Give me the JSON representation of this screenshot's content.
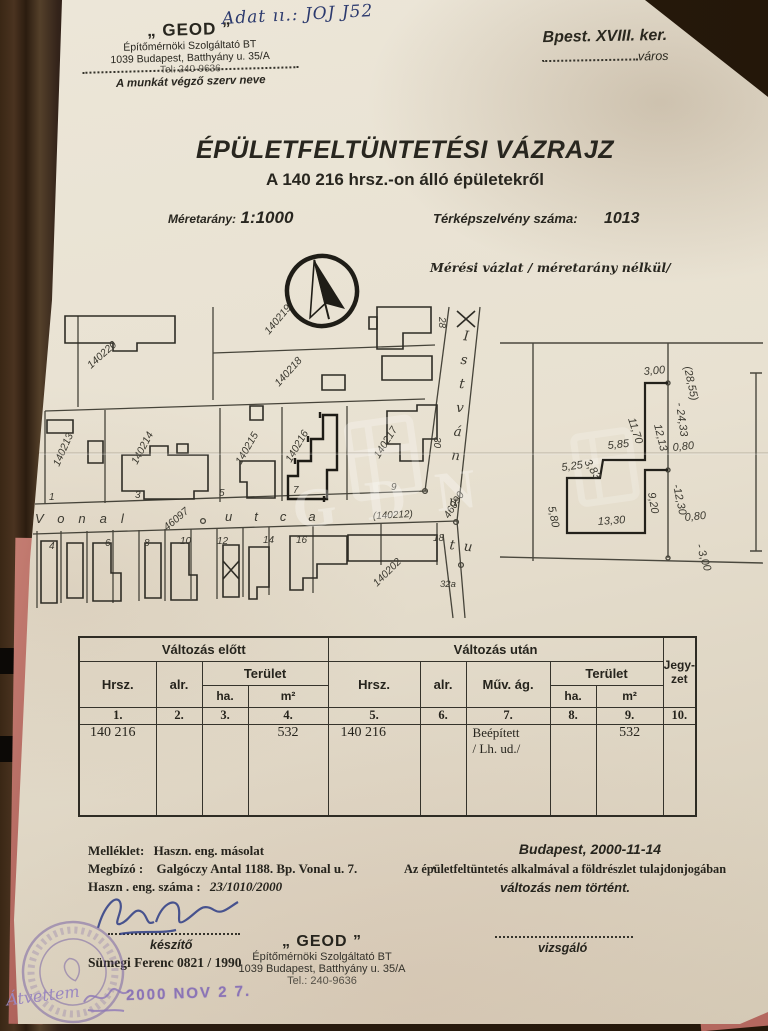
{
  "document": {
    "handwritten_note": "Adat ıı.: JOJ J52",
    "org_stamp": {
      "name": "„ GEOD ”",
      "line1": "Építőmérnöki Szolgáltató BT",
      "line2": "1039 Budapest, Batthyány u. 35/A",
      "phone": "Tel: 240-9636",
      "caption": "A munkát végző szerv neve"
    },
    "district": {
      "title": "Bpest. XVIII. ker.",
      "caption": "város"
    },
    "title": "ÉPÜLETFELTÜNTETÉSI VÁZRAJZ",
    "subtitle": "A 140 216  hrsz.-on álló  épületekről",
    "scale_label": "Méretarány:",
    "scale_value": "1:1000",
    "sheet_label": "Térképszelvény száma:",
    "sheet_value": "1013",
    "survey_note": "Mérési vázlat / méretarány nélkül/"
  },
  "watermark": "GDN",
  "map": {
    "parcels": [
      "140220",
      "140219",
      "140218",
      "140213",
      "140214",
      "140215",
      "140216",
      "140217",
      "140202"
    ],
    "street_parcel": "(140212)",
    "street_vonal": "Vonal",
    "street_utca": "utca",
    "street_istvan": "István",
    "street_istvan_u": "u",
    "street_ut": "u t",
    "node_numbers": [
      "46097",
      "46090"
    ],
    "lot_numbers_north": [
      "1",
      "3",
      "5",
      "7",
      "9"
    ],
    "lot_numbers_south": [
      "4",
      "6",
      "8",
      "10",
      "12",
      "14",
      "16",
      "18"
    ],
    "corner_number": "32a",
    "cross_numbers": [
      "28",
      "30"
    ]
  },
  "detail": {
    "dims": [
      "(28,55)",
      "- 24,33",
      "3,00",
      "11,70",
      "12,13",
      "5,85",
      "3,83",
      "5,25",
      "5,80",
      "0,80",
      "9,20",
      "-12,30",
      "13,30",
      "0,80",
      "- 3,00"
    ]
  },
  "table": {
    "group_before": "Változás előtt",
    "group_after": "Változás után",
    "col_hrsz": "Hrsz.",
    "col_alr": "alr.",
    "col_terulet": "Terület",
    "col_ha": "ha.",
    "col_m2": "m²",
    "col_muv_ag": "Műv. ág.",
    "col_jegyzet_1": "Jegy-",
    "col_jegyzet_2": "zet",
    "ordinals": [
      "1.",
      "2.",
      "3.",
      "4.",
      "5.",
      "6.",
      "7.",
      "8.",
      "9.",
      "10."
    ],
    "row": {
      "hrsz_before": "140 216",
      "m2_before": "532",
      "hrsz_after": "140 216",
      "muv_ag_1": "Beépített",
      "muv_ag_2": "/ Lh. ud./",
      "m2_after": "532"
    }
  },
  "footer": {
    "attachment_label": "Melléklet:",
    "attachment_value": "Haszn. eng. másolat",
    "client_label": "Megbízó :",
    "client_value": "Galgóczy Antal 1188. Bp. Vonal u. 7.",
    "period": ".",
    "permit_label": "Haszn . eng. száma :",
    "permit_value": "23/1010/2000",
    "date": "Budapest, 2000-11-14",
    "statement1": "Az épületfeltüntetés alkalmával a földrészlet tulajdonjogában",
    "statement2": "változás nem történt.",
    "maker_caption": "készítő",
    "maker_name": "Sümegi Ferenc 0821 / 1990",
    "examiner_caption": "vizsgáló",
    "org": {
      "name": "„ GEOD ”",
      "line1": "Építőmérnöki Szolgáltató BT",
      "line2": "1039 Budapest, Batthyány u. 35/A",
      "phone": "Tel.: 240-9636"
    },
    "date_stamp": "2000 NOV 2 7.",
    "received_note": "Átvettem"
  }
}
